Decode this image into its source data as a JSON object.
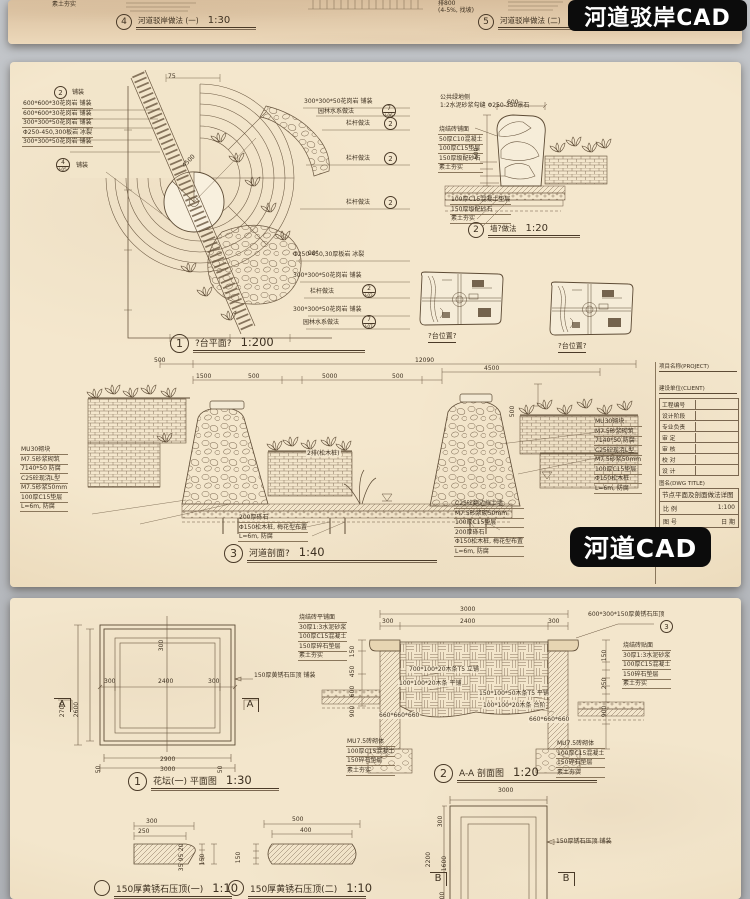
{
  "badges": {
    "top": "河道驳岸CAD",
    "mid": "河道CAD"
  },
  "top_sheet": {
    "callout4": {
      "num": "4",
      "label": "河道驳岸做法 (一)",
      "scale": "1:30"
    },
    "callout5": {
      "num": "5",
      "label": "河道驳岸做法 (二)",
      "scale": "1:30"
    },
    "notes": [
      "素土夯实",
      "排800",
      "(4-5%, 找坡)"
    ]
  },
  "plan": {
    "callout_top": {
      "num": "2",
      "label": "铺装"
    },
    "left_labels": [
      "600*600*30花岗岩 铺装",
      "600*600*30花岗岩 铺装",
      "300*300*50花岗岩 铺装",
      "Φ250-450,300板岩 冰裂",
      "300*300*50花岗岩 铺装"
    ],
    "callout_mid": {
      "num": "4",
      "label": "铺装",
      "ref": "J-05"
    },
    "dims": {
      "top": "75",
      "radius": "4500",
      "angle": "90°"
    },
    "right_rows": [
      {
        "text": "300*300*50花岗岩 铺装"
      },
      {
        "text": "园林水系做法",
        "num": "7",
        "ref": "J-06"
      },
      {
        "text": "栏杆做法",
        "num": "2"
      },
      {
        "text": "栏杆做法",
        "num": "2"
      },
      {
        "text": "栏杆做法",
        "num": "2"
      }
    ],
    "mid_rows": [
      {
        "text": "Φ250-450,30厚板岩 冰裂"
      },
      {
        "text": "300*300*50花岗岩 铺装"
      },
      {
        "text": "栏杆做法",
        "num": "2",
        "ref": "J-02"
      },
      {
        "text": "300*300*50花岗岩 铺装"
      },
      {
        "text": "园林水系做法",
        "num": "7",
        "ref": "J-07"
      }
    ],
    "callout": {
      "num": "1",
      "label": "?台平面?",
      "scale": "1:200"
    }
  },
  "wall_detail": {
    "top_notes": [
      "公共绿地侧",
      "1:2水泥砂浆勾缝 Φ250-350景石"
    ],
    "left_notes": [
      "烧结砖铺面",
      "50厚C10混凝土",
      "100厚C15垫层",
      "150厚级配砂石",
      "素土夯实"
    ],
    "bottom_notes": [
      "100厚C15混凝土垫层",
      "150厚级配砂石",
      "素土夯实"
    ],
    "dim_top": "600",
    "dim_left": "600",
    "callout": {
      "num": "2",
      "label": "墙?做法",
      "scale": "1:20"
    }
  },
  "key_plans": {
    "label1": "?台位置?",
    "label2": "?台位置?"
  },
  "section": {
    "dims_top": [
      "500",
      "12090"
    ],
    "dims_row2": [
      "1500",
      "500",
      "5000",
      "500"
    ],
    "dim_4500": "4500",
    "dim_500a": "500",
    "water_note": "2排(松木桩)",
    "left_notes": [
      "MU30砌块",
      "M7.5砂浆砌筑",
      "7140*50 防腐",
      "C25砼现浇L型",
      "M7.5砂浆50mm",
      "100厚C15垫层",
      "L=6m, 防腐"
    ],
    "mid_notes": [
      "200厚砾石",
      "Φ150松木桩, 梅花型布置",
      "L=6m, 防腐"
    ],
    "right_notes": [
      "MU30砌块",
      "M7.5砂浆砌筑",
      "7140*50 防腐",
      "C25砼现浇L型",
      "M7.5砂浆50mm",
      "100厚C15垫层",
      "Φ150松木桩",
      "L=6m, 防腐"
    ],
    "mid2_notes": [
      "C25砼翻边挡土墙",
      "M7.5砂浆砌50mm",
      "100厚C15垫层",
      "200厚砾石",
      "Φ150松木桩, 梅花型布置",
      "L=6m, 防腐"
    ],
    "callout": {
      "num": "3",
      "label": "河道剖面?",
      "scale": "1:40"
    }
  },
  "title_block": {
    "project_label": "项目名称(PROJECT)",
    "client_label": "建设单位(CLIENT)",
    "rows": [
      "工程编号",
      "设计阶段",
      "专业负责",
      "审 定",
      "审 核",
      "校 对",
      "设 计"
    ],
    "dwg_label": "图名(DWG TITLE)",
    "dwg_title": "节点平面及剖面做法详图",
    "scale_label": "比 例",
    "scale_value": "1:100",
    "no_label": "图 号",
    "date_label": "日 期"
  },
  "flower_bed": {
    "plan": {
      "dim_left_outer": "2700",
      "dim_left_inner": "2600",
      "dim_top": "300",
      "dims_mid": [
        "300",
        "2400",
        "300"
      ],
      "dim_bottom1": "2900",
      "dim_bottom2": "3000",
      "dim_small1": "50",
      "dim_small2": "50",
      "marker": "A",
      "leader_note": "150厚黄锈石压顶 铺装",
      "notes": [
        "烧结砖平铺面",
        "30厚1:3水泥砂浆",
        "100厚C15混凝土",
        "150厚碎石垫层",
        "素土夯实"
      ],
      "callout": {
        "num": "1",
        "label": "花坛(一) 平面图",
        "scale": "1:30"
      }
    },
    "section": {
      "dim_top": "3000",
      "dims_row2": [
        "300",
        "2400",
        "300"
      ],
      "coping_note": "600*300*150厚黄锈石压顶",
      "coping_num": "3",
      "left_dims": [
        "150",
        "450",
        "600",
        "900"
      ],
      "right_dims": [
        "150",
        "250",
        "900"
      ],
      "inner_labels": [
        "700*100*20木条T5 立铺",
        "100*100*20木条 平铺",
        "150*100*50木条T5 平铺",
        "100*100*20木条 台阶"
      ],
      "block_dim_left": "660*660*660",
      "block_dim_right": "660*660*660",
      "left_notes": [
        "MU7.5砖砌体",
        "100厚C15混凝土",
        "150碎石垫层",
        "素土夯实"
      ],
      "right_notes": [
        "MU7.5砖砌体",
        "100厚C15混凝土",
        "150碎石垫层",
        "素土夯实"
      ],
      "side_notes": [
        "烧结砖贴面",
        "30厚1:3水泥砂浆",
        "100厚C15混凝土",
        "150碎石垫层",
        "素土夯实"
      ],
      "callout": {
        "num": "2",
        "label": "A-A 剖面图",
        "scale": "1:20"
      }
    },
    "coping1": {
      "dims_top": [
        "300",
        "250"
      ],
      "dims_side": [
        "20",
        "95",
        "35"
      ],
      "dim_h": "150",
      "label": "150厚黄锈石压顶(一)",
      "scale": "1:10"
    },
    "coping2": {
      "dims_top": [
        "500",
        "400"
      ],
      "dim_h": "150",
      "label": "150厚黄锈石压顶(二)",
      "scale": "1:10"
    },
    "plan2": {
      "dim_top": "3000",
      "dim_left_outer": "2200",
      "dims_left": [
        "300",
        "1600",
        "300"
      ],
      "leader_note": "150厚锈石压顶 铺装",
      "marker": "B"
    }
  }
}
